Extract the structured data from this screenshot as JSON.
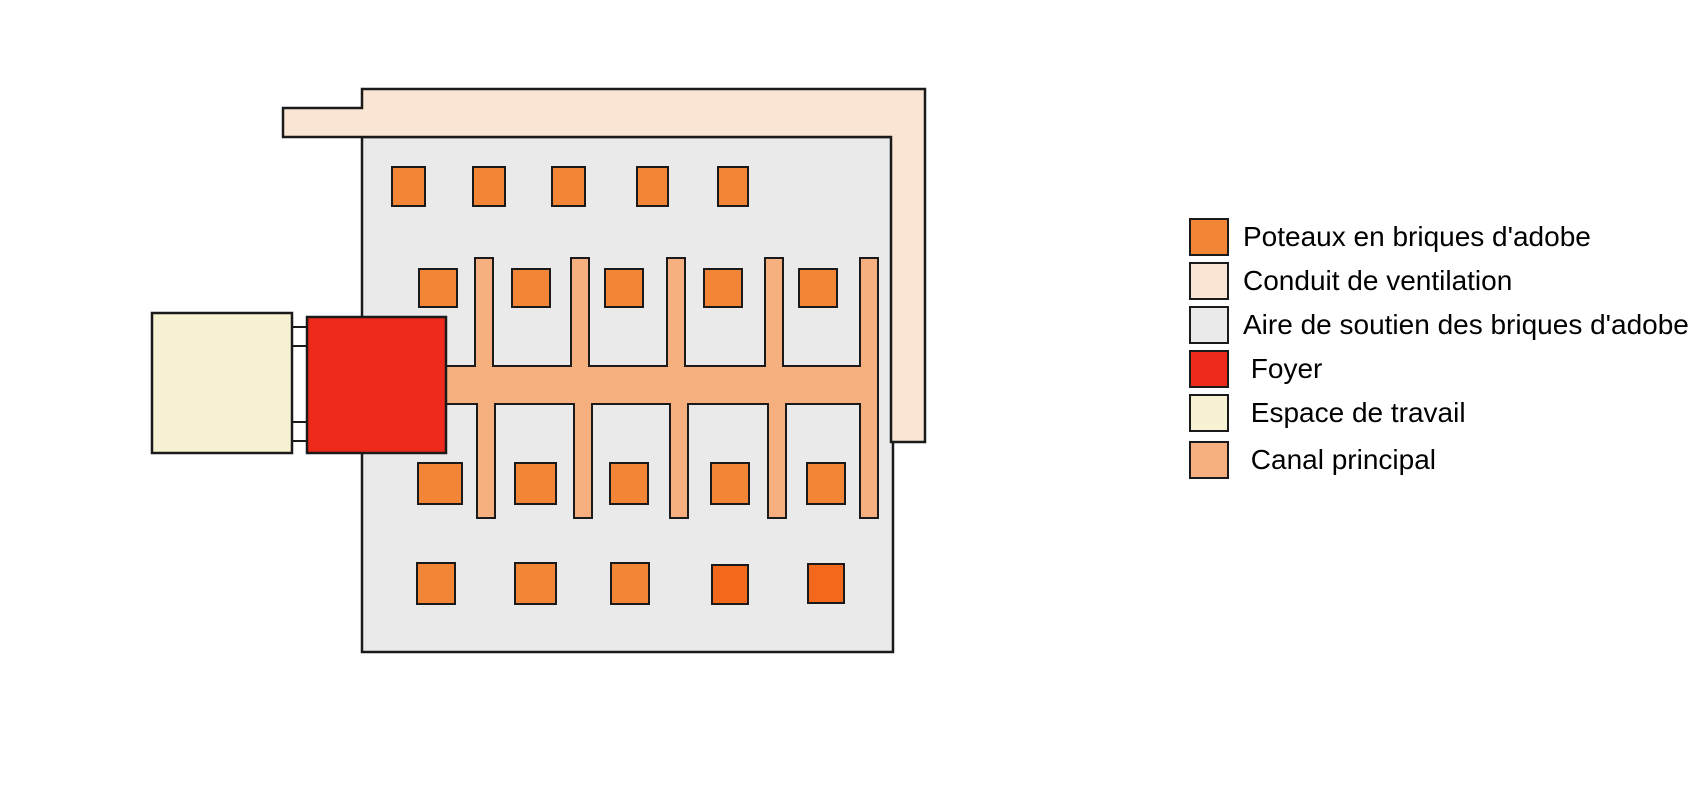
{
  "colors": {
    "pillar_orange": "#F28536",
    "pillar_deep_orange": "#F2691C",
    "ventilation_pink": "#FAE4D3",
    "support_grey": "#EAEAEA",
    "hearth_red": "#EE2A1D",
    "workspace_cream": "#F7F3D2",
    "channel_peach": "#F6B07F",
    "connector_white": "#FFFFFF",
    "outline": "#1A1A1A",
    "background": "#FFFFFF"
  },
  "legend": {
    "items": [
      {
        "id": "adobe-pillars",
        "label": "Poteaux en briques d'adobe",
        "color": "#F28536"
      },
      {
        "id": "ventilation-duct",
        "label": "Conduit de ventilation",
        "color": "#FAE4D3"
      },
      {
        "id": "support-area",
        "label": "Aire de soutien des briques d'adobe",
        "color": "#EAEAEA"
      },
      {
        "id": "hearth",
        "label": " Foyer",
        "color": "#EE2A1D"
      },
      {
        "id": "workspace",
        "label": " Espace de travail",
        "color": "#F7F3D2"
      },
      {
        "id": "main-channel",
        "label": " Canal principal",
        "color": "#F6B07F"
      }
    ]
  },
  "diagram": {
    "pillar_rows": 4,
    "pillar_columns": 5,
    "pillar_count": 20,
    "up_branch_count": 5,
    "down_branch_count": 5
  }
}
